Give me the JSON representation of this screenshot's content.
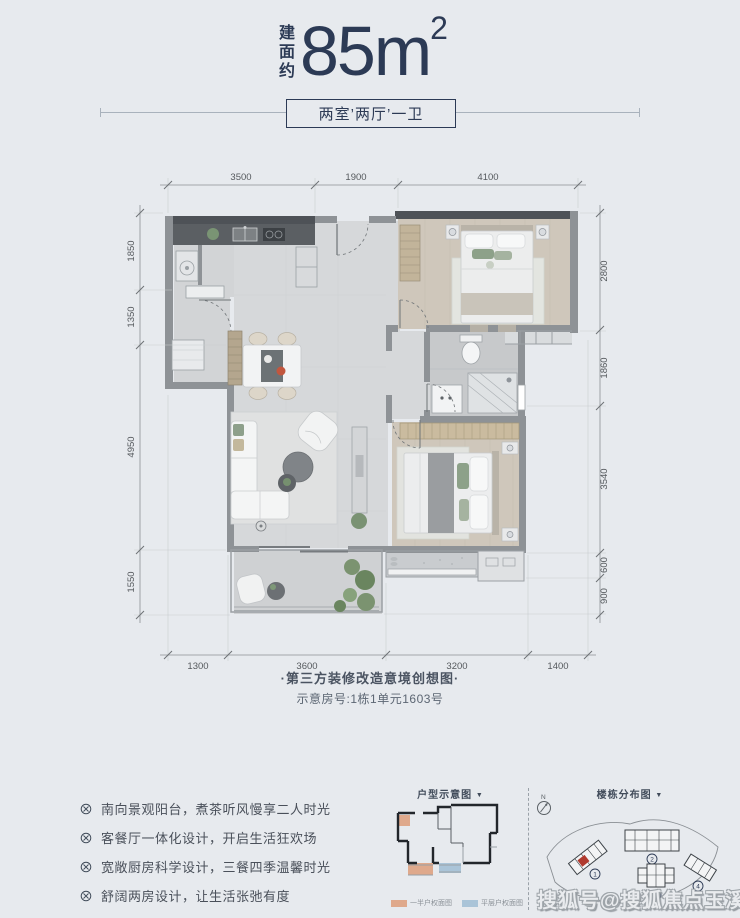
{
  "header": {
    "area_prefix": "建面约",
    "area_value": "85m",
    "area_sup": "2",
    "layout_label": "两室’两厅’一卫"
  },
  "plan": {
    "dims_top": [
      "3500",
      "1900",
      "4100"
    ],
    "dims_bottom": [
      "1300",
      "3600",
      "3200",
      "1400"
    ],
    "dims_left": [
      "1850",
      "1350",
      "4950",
      "1550"
    ],
    "dims_right": [
      "2800",
      "1860",
      "3540",
      "600",
      "900"
    ],
    "caption_line1": "·第三方装修改造意境创想图·",
    "caption_line2": "示意房号:1栋1单元1603号"
  },
  "features": {
    "items": [
      "南向景观阳台，煮茶听风慢享二人时光",
      "客餐厅一体化设计，开启生活狂欢场",
      "宽敞厨房科学设计，三餐四季温馨时光",
      "舒阔两房设计，让生活张弛有度"
    ]
  },
  "mini_plan": {
    "title": "户型示意图",
    "arrow": "▼",
    "legend": [
      {
        "label": "一半户权面图",
        "color": "#dfa98c"
      },
      {
        "label": "平层户权面图",
        "color": "#aac4d8"
      }
    ]
  },
  "site_map": {
    "title": "楼栋分布图",
    "arrow": "▼",
    "compass_label": "N",
    "buildings": [
      "1",
      "2",
      "3",
      "4"
    ]
  },
  "watermark": "搜狐号@搜狐焦点玉溪站",
  "colors": {
    "accent_navy": "#2c3a55",
    "background": "#e7eaee",
    "highlight_red": "#b03a2e",
    "legend_orange": "#dfa98c",
    "legend_blue": "#aac4d8"
  }
}
